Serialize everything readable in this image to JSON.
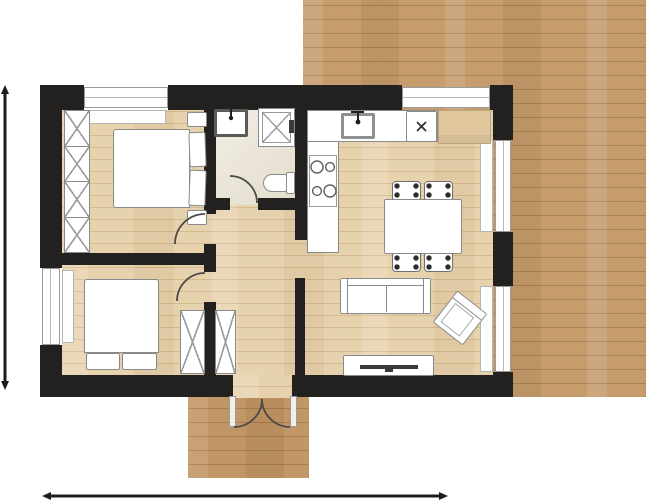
{
  "page": {
    "kind": "architectural floor plan, top-down 2D view, no text labels visible",
    "canvas": {
      "width": 646,
      "height": 502,
      "background": "#ffffff"
    }
  },
  "colors": {
    "wall": "#232120",
    "exterior_wood": "#c69c6d",
    "exterior_wood_line": "#aa8056",
    "interior_wood": "#e7d2ae",
    "interior_wood_line": "#d4ba90",
    "bathroom_tile": "#eae4d3",
    "fixture_outline": "#8a8a8a",
    "dimension_line": "#1c1c1c",
    "door_arc": "#4a4a48"
  },
  "plan": {
    "rooms": [
      {
        "name": "bedroom-1",
        "position": "top-left",
        "furniture": [
          "double-bed with two pillows",
          "nightstand x2",
          "wardrobe with 4 X-sections",
          "window sill unit"
        ]
      },
      {
        "name": "bathroom",
        "position": "top-center",
        "furniture": [
          "washbasin with tap",
          "shower cabin",
          "toilet"
        ]
      },
      {
        "name": "kitchen",
        "position": "top-center-right",
        "furniture": [
          "L-shaped counter",
          "sink with tap",
          "hob with 4 burners",
          "appliance marked x",
          "wood-top cabinet"
        ]
      },
      {
        "name": "living-dining",
        "position": "right",
        "furniture": [
          "dining table",
          "chair x4",
          "three-seat sofa",
          "rotated armchair",
          "tv sideboard with tv"
        ]
      },
      {
        "name": "bedroom-2",
        "position": "bottom-left",
        "furniture": [
          "double-bed with two pillows",
          "wardrobe X-section"
        ]
      },
      {
        "name": "hallway",
        "position": "center",
        "furniture": [
          "wardrobe X-section"
        ]
      }
    ],
    "openings": {
      "windows": [
        "top wall left",
        "top wall right",
        "left wall",
        "right wall upper",
        "right wall lower"
      ],
      "interior_doors": [
        "bathroom",
        "bedroom-1",
        "bedroom-2"
      ],
      "entrance": "double outward-swinging door at bottom wall with wood porch"
    },
    "exterior": [
      "large wood deck top-right",
      "wood porch at entrance bottom-center"
    ],
    "dimension_lines": [
      "vertical at far left with double arrows",
      "horizontal at bottom with double arrows"
    ],
    "counts": {
      "wardrobe1_sections": 4,
      "dining_chairs": 4,
      "hob_burners": 4,
      "sofa_seats": 2
    }
  }
}
